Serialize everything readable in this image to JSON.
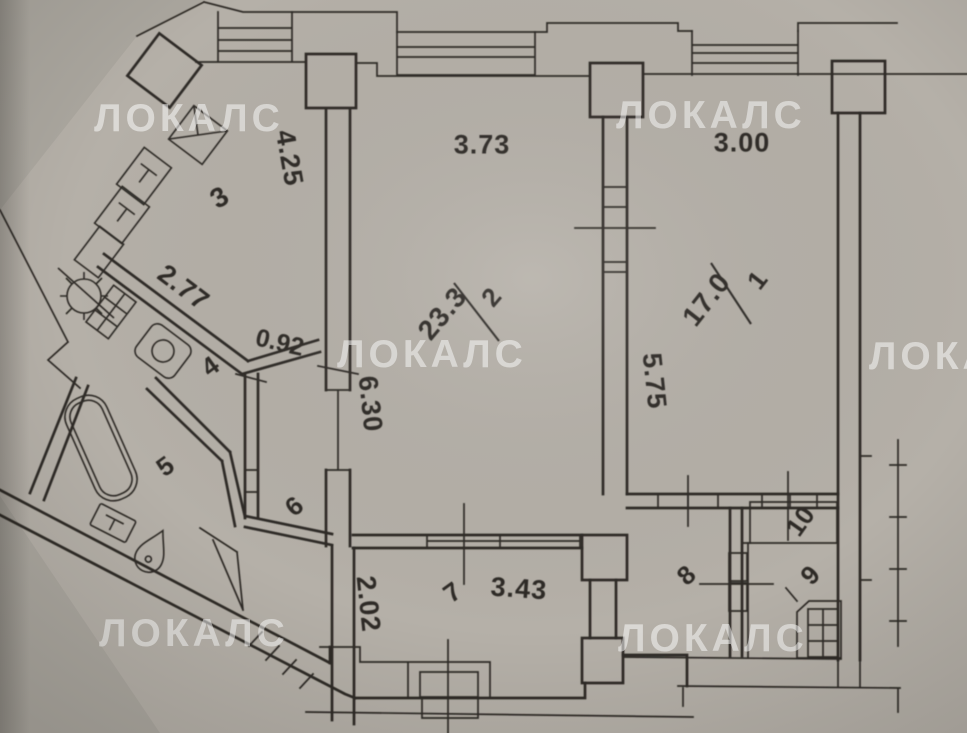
{
  "watermark": {
    "text": "ЛОКАЛС",
    "color": "rgba(255,255,255,0.52)"
  },
  "colors": {
    "paper": "#b5b0a8",
    "ink": "#2e2c27"
  },
  "rooms": [
    {
      "number": "1",
      "area": "17.0"
    },
    {
      "number": "2",
      "area": "23.3"
    },
    {
      "number": "3"
    },
    {
      "number": "4"
    },
    {
      "number": "5"
    },
    {
      "number": "6"
    },
    {
      "number": "7"
    },
    {
      "number": "8"
    },
    {
      "number": "9"
    },
    {
      "number": "10"
    }
  ],
  "dimensions": {
    "kitchen_top": "4.25",
    "room2_top": "3.73",
    "room1_top": "3.00",
    "kitchen_diagonal": "2.77",
    "hall_nook": "0.92",
    "room2_left": "6.30",
    "room1_left": "5.75",
    "loggia_left": "2.02",
    "loggia_bottom": "3.43"
  }
}
